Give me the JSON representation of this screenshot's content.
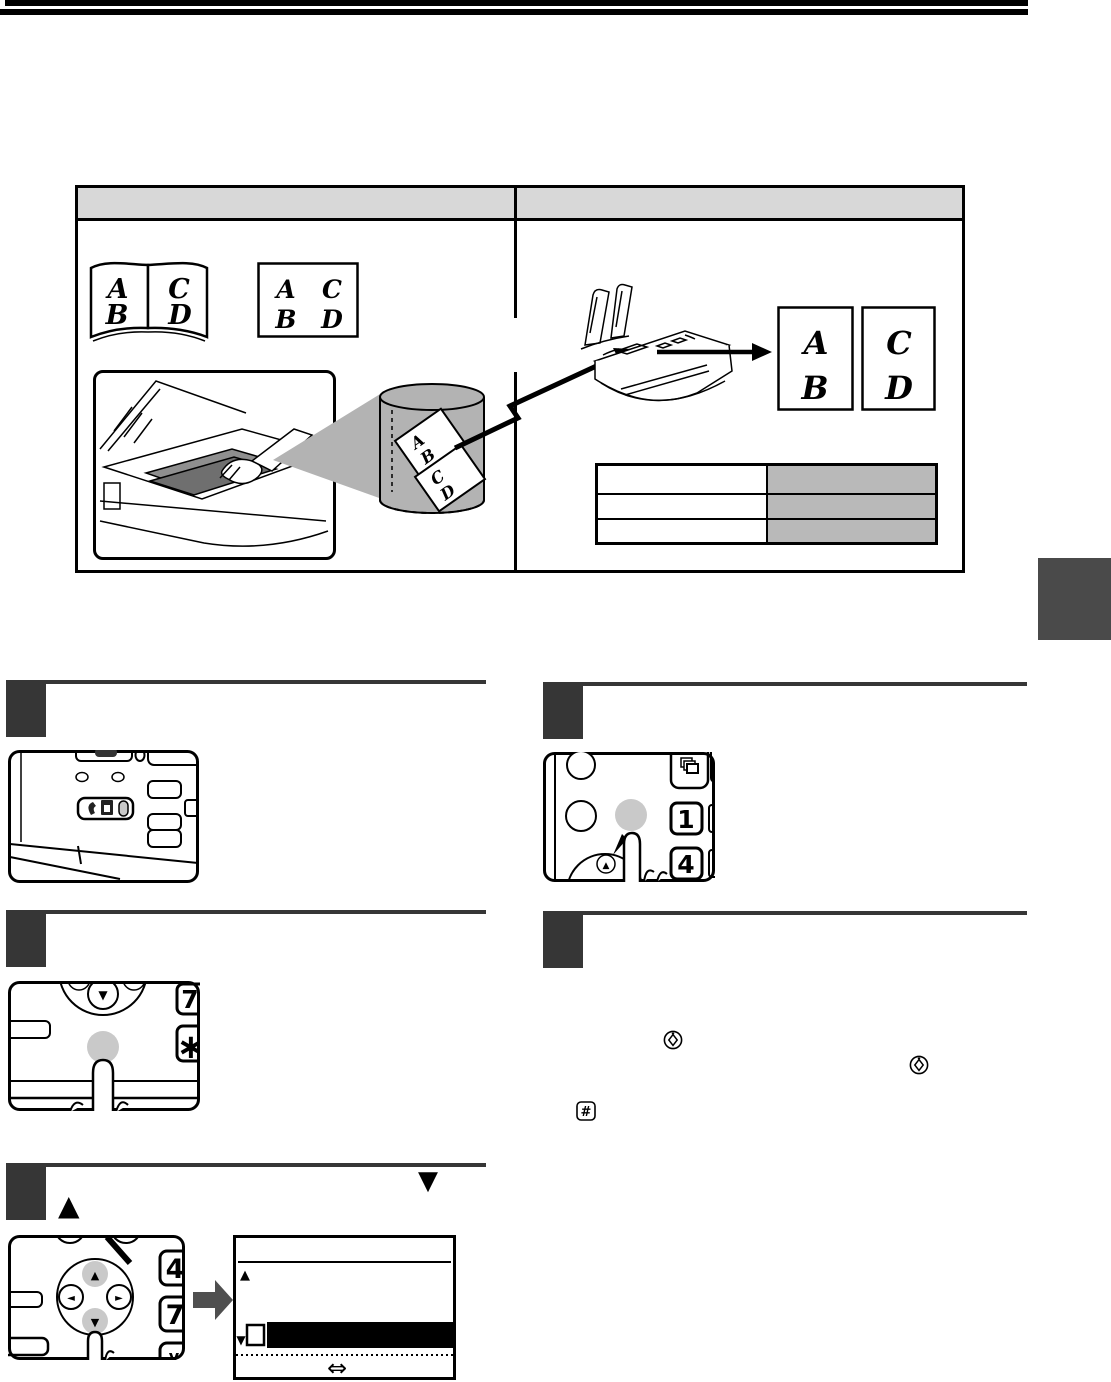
{
  "colors": {
    "rule_black": "#000000",
    "step_dark": "#363636",
    "table_header_bg": "#d8d8d8",
    "mini_cell_bg": "#b9b9b9",
    "cylinder_gray": "#b3b3b3",
    "pressed_button_gray": "#c9c9c9",
    "side_tab_gray": "#4a4a4a",
    "block_arrow_gray": "#4f4f4f"
  },
  "comparison": {
    "book": {
      "left_top": "A",
      "left_bottom": "B",
      "right_top": "C",
      "right_bottom": "D"
    },
    "sheet": {
      "tl": "A",
      "tr": "C",
      "bl": "B",
      "br": "D"
    },
    "cylinder": {
      "s1_top": "A",
      "s1_bottom": "B",
      "s2_top": "C",
      "s2_bottom": "D"
    },
    "pages": {
      "p1_top": "A",
      "p1_bottom": "B",
      "p2_top": "C",
      "p2_bottom": "D"
    },
    "mini_table": {
      "rows": 3,
      "columns": 2
    }
  },
  "steps": {
    "s2": {
      "key_7": "7",
      "key_star": "∗",
      "nav_down": "▼"
    },
    "s3": {
      "head_down": "▼",
      "head_up": "▲",
      "key_4": "4",
      "key_7": "7",
      "key_partial": "v",
      "pad_up": "▲",
      "pad_down": "▼",
      "pad_left": "◄",
      "pad_right": "►",
      "display": {
        "up_marker": "▲",
        "down_marker": "▼",
        "swap_symbol": "⇔"
      }
    },
    "s4": {
      "key_1": "1",
      "key_4": "4",
      "pad_up": "▲"
    },
    "s5": {
      "hash": "#"
    }
  }
}
